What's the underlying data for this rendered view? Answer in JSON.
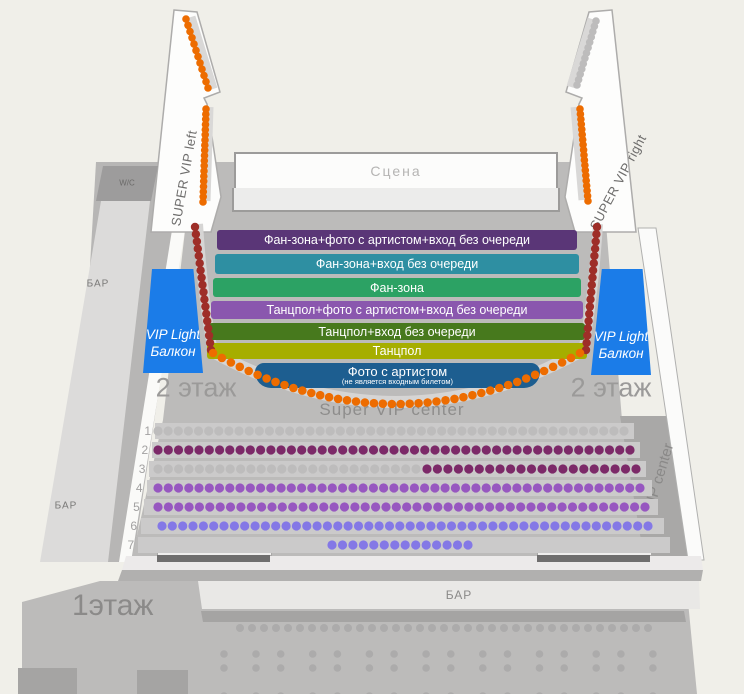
{
  "stage": {
    "label": "Сцена"
  },
  "zones": [
    {
      "label": "Фан-зона+фото с артистом+вход без очереди",
      "color": "#5a3677"
    },
    {
      "label": "Фан-зона+вход без очереди",
      "color": "#2e8fa2"
    },
    {
      "label": "Фан-зона",
      "color": "#2ca264"
    },
    {
      "label": "Танцпол+фото с артистом+вход без очереди",
      "color": "#8a57ae"
    },
    {
      "label": "Танцпол+вход без очереди",
      "color": "#47791d"
    },
    {
      "label": "Танцпол",
      "color": "#a6ae00"
    },
    {
      "label": "Фото с артистом",
      "sub": "(не является входным билетом)",
      "color": "#1d5e90"
    }
  ],
  "vip_light": {
    "line1": "VIP Light",
    "line2": "Балкон",
    "color": "#1b7ce8"
  },
  "labels": {
    "super_vip_left": "SUPER VIP left",
    "super_vip_right": "SUPER VIP right",
    "super_vip_center": "Super VIP center",
    "vip_center": "VIP center",
    "floor2": "2 этаж",
    "floor1": "1этаж",
    "wc": "W/C",
    "bar": "БАР"
  },
  "seat_rows": [
    {
      "number": "1",
      "segments": [
        {
          "color_key": "graydot",
          "x1": 158,
          "x2": 624,
          "count": 47
        }
      ]
    },
    {
      "number": "2",
      "segments": [
        {
          "color_key": "plum",
          "x1": 158,
          "x2": 630,
          "count": 47
        }
      ]
    },
    {
      "number": "3",
      "segments": [
        {
          "color_key": "graydot",
          "x1": 158,
          "x2": 416,
          "count": 26
        },
        {
          "color_key": "plum",
          "x1": 427,
          "x2": 636,
          "count": 21
        }
      ]
    },
    {
      "number": "4",
      "segments": [
        {
          "color_key": "purple",
          "x1": 158,
          "x2": 640,
          "count": 48
        }
      ]
    },
    {
      "number": "5",
      "segments": [
        {
          "color_key": "purple",
          "x1": 158,
          "x2": 645,
          "count": 48
        }
      ]
    },
    {
      "number": "6",
      "segments": [
        {
          "color_key": "violet",
          "x1": 162,
          "x2": 648,
          "count": 48
        }
      ]
    },
    {
      "number": "7",
      "segments": [
        {
          "color_key": "violet",
          "x1": 332,
          "x2": 468,
          "count": 14
        }
      ]
    }
  ],
  "dot_lines": [
    {
      "name": "left-wing-top-dots",
      "color_key": "orange",
      "x1": 186,
      "y1": 19,
      "x2": 208,
      "y2": 88,
      "count": 12,
      "r": 3.8
    },
    {
      "name": "left-wing-lower-dots",
      "color_key": "orange",
      "x1": 206,
      "y1": 109,
      "x2": 203,
      "y2": 202,
      "count": 19,
      "r": 3.8
    },
    {
      "name": "right-wing-top-dots",
      "color_key": "graydot",
      "x1": 596,
      "y1": 21,
      "x2": 577,
      "y2": 85,
      "count": 13,
      "r": 3.8
    },
    {
      "name": "right-wing-lower-dots",
      "color_key": "orange",
      "x1": 580,
      "y1": 109,
      "x2": 588,
      "y2": 201,
      "count": 19,
      "r": 3.8
    },
    {
      "name": "left-balcony-edge-dots",
      "color_key": "maroon",
      "x1": 195,
      "y1": 227,
      "x2": 211,
      "y2": 350,
      "count": 18,
      "r": 4.2
    },
    {
      "name": "right-balcony-edge-dots",
      "color_key": "maroon",
      "x1": 597,
      "y1": 227,
      "x2": 586,
      "y2": 350,
      "count": 18,
      "r": 4.2
    }
  ],
  "dot_arc": {
    "name": "super-vip-center-arc-dots",
    "color_key": "orange",
    "x1": 213,
    "y1": 353,
    "cx": 396,
    "cy": 455,
    "x2": 580,
    "y2": 353,
    "count": 42,
    "r": 4.3
  },
  "floor1_dots": {
    "y": 628,
    "x1": 240,
    "x2": 648,
    "count": 35,
    "r": 4,
    "color_key": "f1dot"
  },
  "tables": {
    "x_start": 240,
    "x_step": 56.7,
    "rows": [
      {
        "y": 661,
        "labels": [
          "1",
          "2",
          "3",
          "4",
          "5",
          "6",
          "7",
          "8"
        ]
      },
      {
        "y": 703,
        "labels": [
          "1",
          "2",
          "3",
          "4",
          "5",
          "6",
          "7",
          "8"
        ]
      }
    ]
  },
  "colors": {
    "orange": "#ed6c00",
    "maroon": "#9e2e28",
    "graydot": "#bdbcbc",
    "plum": "#7c2968",
    "purple": "#9757c0",
    "violet": "#8478e6",
    "f1dot": "#acabab"
  }
}
